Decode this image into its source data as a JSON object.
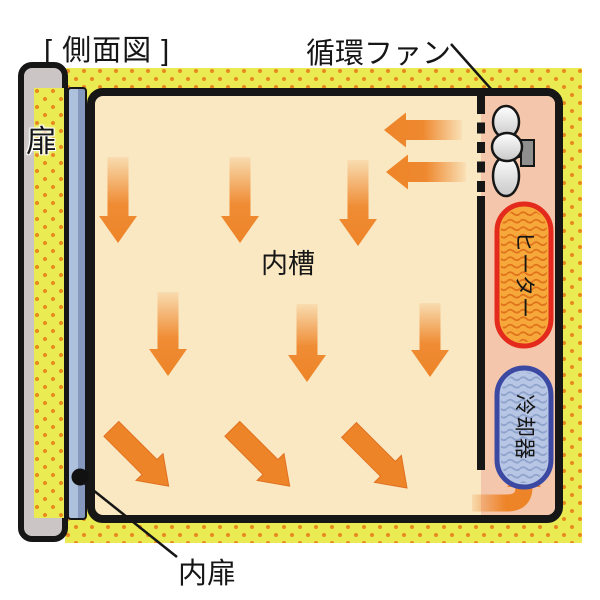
{
  "title": "[ 側面図 ]",
  "labels": {
    "circulation_fan": "循環ファン",
    "door": "扉",
    "inner_chamber": "内槽",
    "inner_door": "内扉",
    "heater": "ヒーター",
    "cooler": "冷却器"
  },
  "colors": {
    "insulation_yellow": "#EAEA52",
    "insulation_dot_orange": "#E8871E",
    "chamber_cream": "#FAE8C2",
    "fan_compartment_salmon": "#F4C6AB",
    "airflow_arrow_orange": "#EE8428",
    "heater_fill": "#F6A93A",
    "heater_border_red": "#E32A1C",
    "heater_wave": "#E0731C",
    "cooler_fill": "#B7C6E4",
    "cooler_border_blue": "#3B49A3",
    "cooler_wave": "#8FA3CC",
    "door_gray": "#CBC5C5",
    "inner_door_blue": "#ADC1DC",
    "outline_black": "#161616"
  }
}
